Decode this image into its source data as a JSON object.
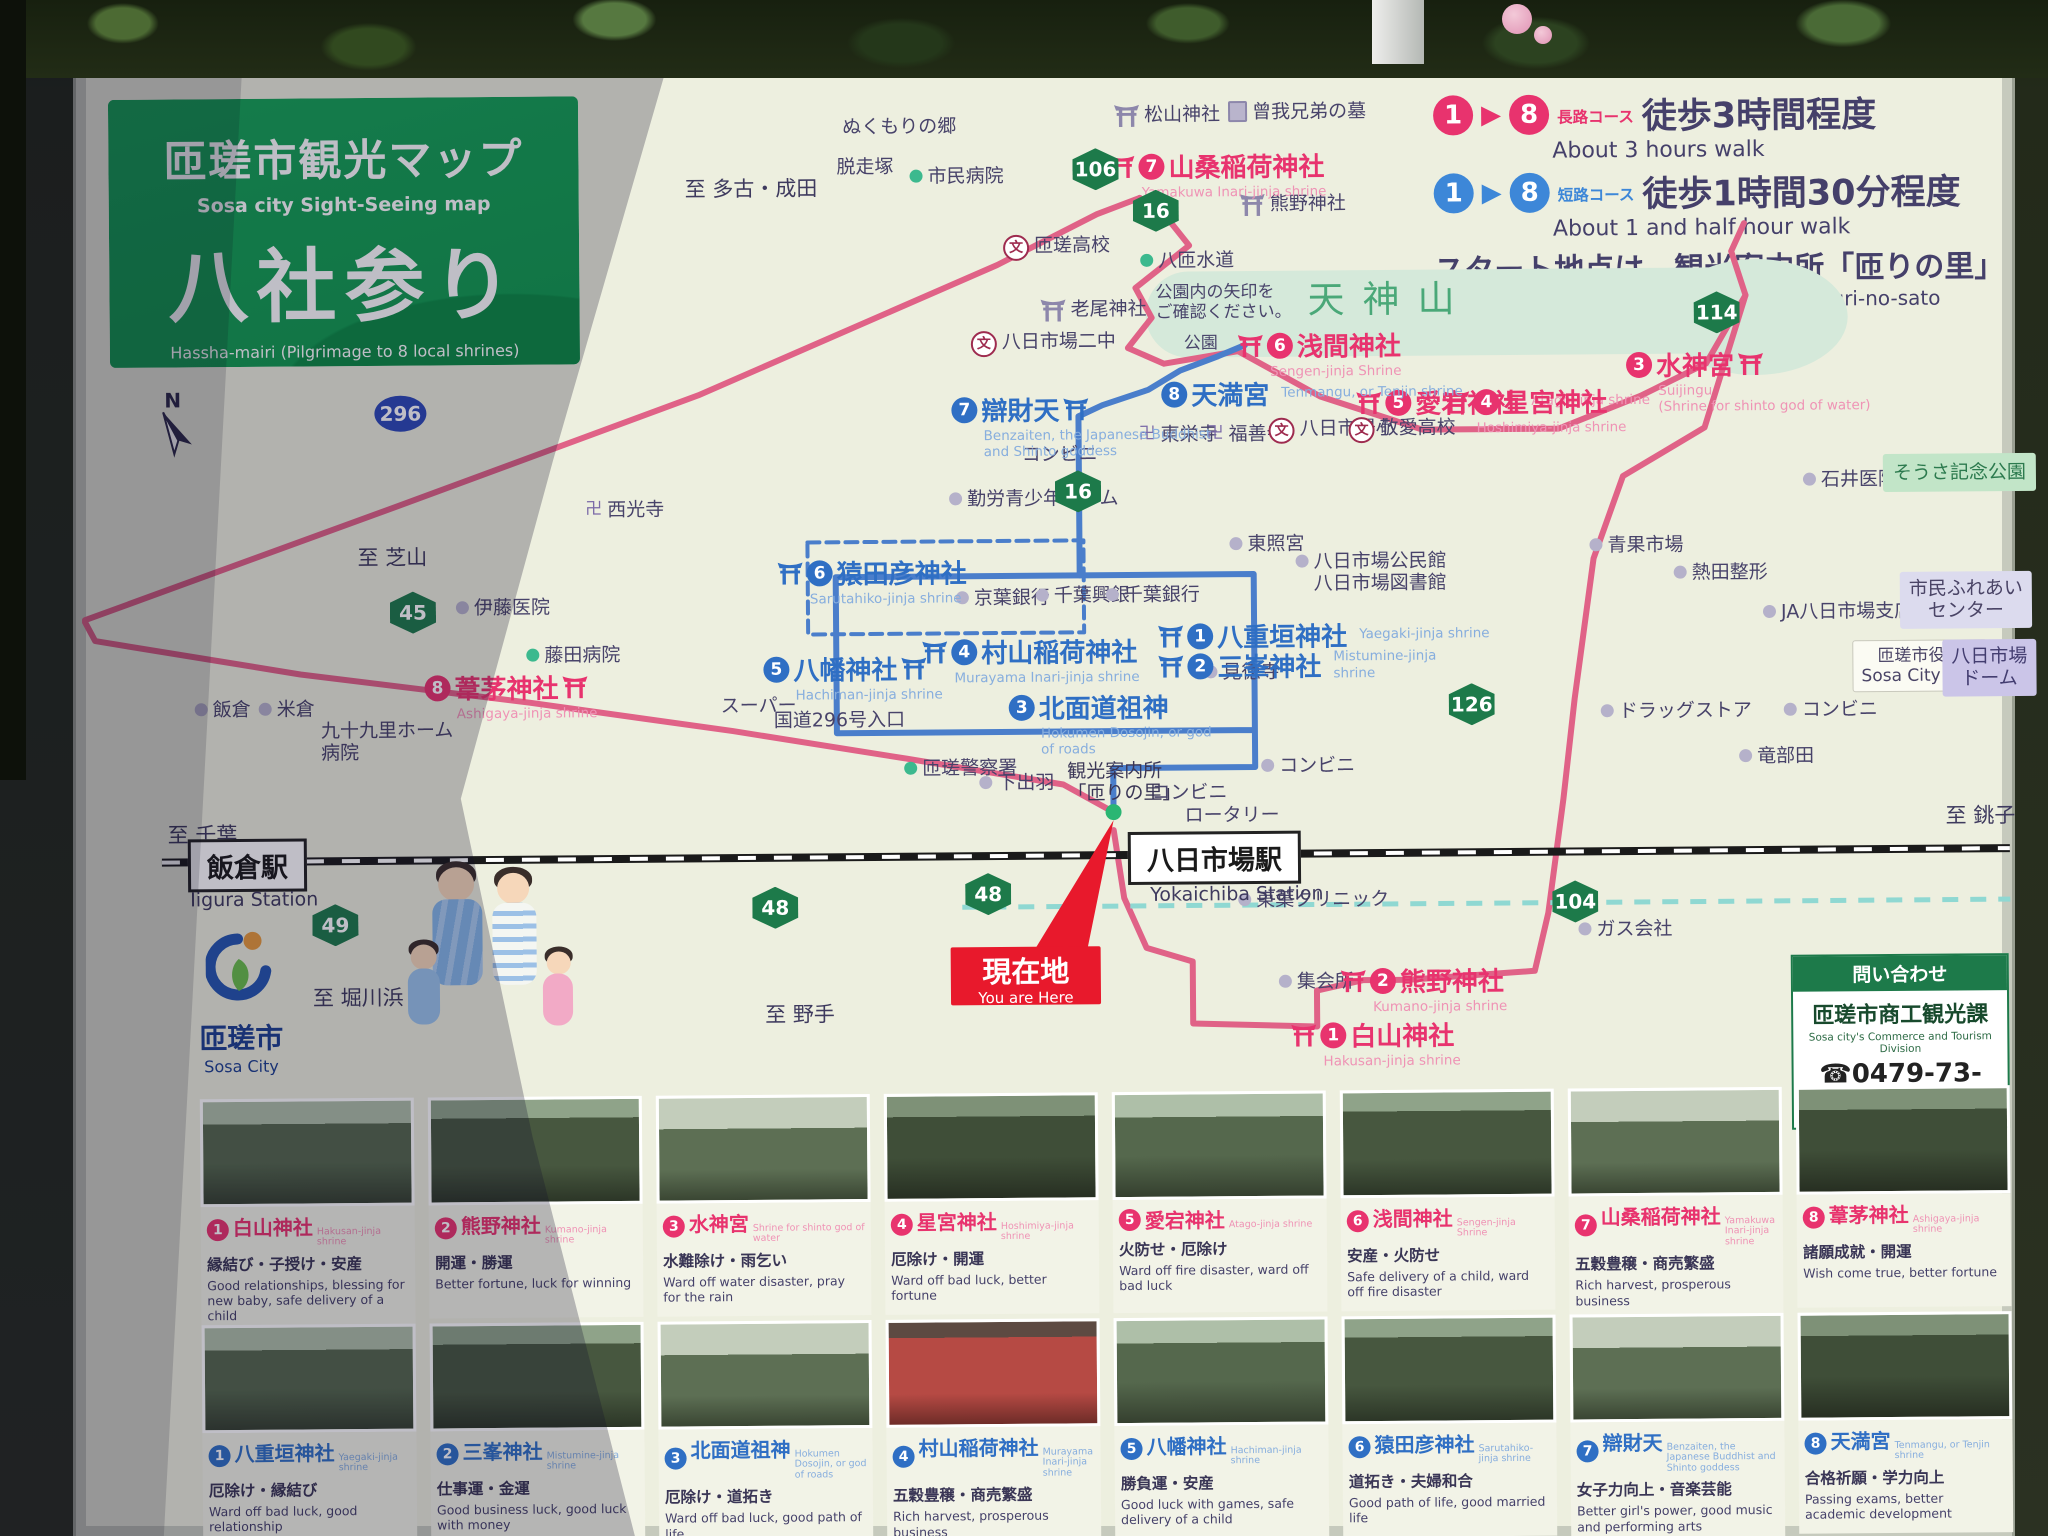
{
  "sign": {
    "title_jp": "匝瑳市観光マップ",
    "title_en": "Sosa city Sight-Seeing map",
    "subtitle_jp": "八社参り",
    "subtitle_en": "Hassha-mairi (Pilgrimage to 8 local shrines)"
  },
  "legend": {
    "long": {
      "from": "1",
      "to": "8",
      "arrow": "▶",
      "course_jp": "長路コース",
      "detail_jp": "徒歩3時間程度",
      "en": "About 3 hours walk",
      "color": "#e8336e"
    },
    "short": {
      "from": "1",
      "to": "8",
      "arrow": "▶",
      "course_jp": "短路コース",
      "detail_jp": "徒歩1時間30分程度",
      "en": "About 1 and half hour walk",
      "color": "#3d87d8"
    },
    "start_jp": "スタート地点は、観光案内所「匝りの里」",
    "start_en": "Start at tourist information center, Meguri-no-sato"
  },
  "compass_label": "N",
  "you_are_here": {
    "jp": "現在地",
    "en": "You are Here"
  },
  "city_logo": {
    "jp": "匝瑳市",
    "en": "Sosa City"
  },
  "contact": {
    "header": "問い合わせ",
    "dept": "匝瑳市商工観光課",
    "dept_en": "Sosa city's Commerce and Tourism Division",
    "phone": "☎0479-73-0014"
  },
  "map": {
    "park_area_label": "天神山",
    "stations": [
      {
        "jp": "飯倉駅",
        "en": "Iigura Station",
        "x": 186,
        "y": 832,
        "enx": 188,
        "eny": 882
      },
      {
        "jp": "八日市場駅",
        "en": "Yokaichiba Station",
        "x": 1126,
        "y": 832,
        "enx": 1148,
        "eny": 884
      }
    ],
    "shrine_markers": [
      {
        "num": "7",
        "color": "pink",
        "name": "山桑稲荷神社",
        "romaji": "Yamakuwa Inari-jinja shrine",
        "x": 1113,
        "y": 148,
        "icon": "left",
        "rpos": "below"
      },
      {
        "num": "6",
        "color": "pink",
        "name": "浅間神社",
        "romaji": "Sengen-jinja Shrine",
        "x": 1240,
        "y": 328,
        "icon": "left",
        "rpos": "below"
      },
      {
        "num": "5",
        "color": "pink",
        "name": "愛宕神社",
        "romaji": "Atago-jinja shrine",
        "x": 1358,
        "y": 386,
        "icon": "left",
        "rpos": "right"
      },
      {
        "num": "4",
        "color": "pink",
        "name": "星宮神社",
        "romaji": "Hoshimiya-jinja shrine",
        "x": 1446,
        "y": 386,
        "icon": "left",
        "rpos": "below"
      },
      {
        "num": "3",
        "color": "pink",
        "name": "水神宮",
        "romaji": "Suijingu\n(Shrine for shinto god of water)",
        "x": 1628,
        "y": 350,
        "icon": "right",
        "rpos": "below"
      },
      {
        "num": "8",
        "color": "pink",
        "name": "葦茅神社",
        "romaji": "Ashigaya-jinja shrine",
        "x": 424,
        "y": 664,
        "icon": "right",
        "rpos": "below"
      },
      {
        "num": "2",
        "color": "pink",
        "name": "熊野神社",
        "romaji": "Kumano-jinja shrine",
        "x": 1338,
        "y": 964,
        "icon": "left",
        "rpos": "below"
      },
      {
        "num": "1",
        "color": "pink",
        "name": "白山神社",
        "romaji": "Hakusan-jinja shrine",
        "x": 1288,
        "y": 1018,
        "icon": "left",
        "rpos": "below"
      },
      {
        "num": "7",
        "color": "blue",
        "name": "辯財天",
        "romaji": "Benzaiten, the Japanese Buddhist\nand Shinto goddess",
        "x": 953,
        "y": 390,
        "icon": "right",
        "rpos": "below"
      },
      {
        "num": "8",
        "color": "blue",
        "name": "天満宮",
        "romaji": "Tenmangu, or Tenjin shrine",
        "x": 1163,
        "y": 376,
        "icon": "none",
        "rpos": "right"
      },
      {
        "num": "6",
        "color": "blue",
        "name": "猿田彦神社",
        "romaji": "Sarutahiko-jinja shrine",
        "x": 778,
        "y": 552,
        "icon": "left",
        "rpos": "below"
      },
      {
        "num": "5",
        "color": "blue",
        "name": "八幡神社",
        "romaji": "Hachiman-jinja shrine",
        "x": 763,
        "y": 648,
        "icon": "right",
        "rpos": "below"
      },
      {
        "num": "4",
        "color": "blue",
        "name": "村山稲荷神社",
        "romaji": "Murayama Inari-jinja shrine",
        "x": 922,
        "y": 632,
        "icon": "left",
        "rpos": "below"
      },
      {
        "num": "3",
        "color": "blue",
        "name": "北面道祖神",
        "romaji": "Hokumen Dosojin, or god\nof roads",
        "x": 1008,
        "y": 688,
        "icon": "none",
        "rpos": "below"
      },
      {
        "num": "1",
        "color": "blue",
        "name": "八重垣神社",
        "romaji": "Yaegaki-jinja shrine",
        "x": 1158,
        "y": 618,
        "icon": "left",
        "rpos": "right"
      },
      {
        "num": "2",
        "color": "blue",
        "name": "三峯神社",
        "romaji": "Mistumine-jinja\nshrine",
        "x": 1158,
        "y": 648,
        "icon": "left",
        "rpos": "right"
      }
    ],
    "labels": [
      {
        "t": "松山神社",
        "x": 1118,
        "y": 104,
        "icon": "torii"
      },
      {
        "t": "曾我兄弟の墓",
        "x": 1232,
        "y": 102,
        "icon": "grave"
      },
      {
        "t": "ぬくもりの郷",
        "x": 846,
        "y": 114
      },
      {
        "t": "脱走塚",
        "x": 840,
        "y": 154
      },
      {
        "t": "市民病院",
        "x": 913,
        "y": 164,
        "icon": "dotg"
      },
      {
        "t": "至 多古・成田",
        "x": 688,
        "y": 174,
        "cls": "dir"
      },
      {
        "t": "熊野神社",
        "x": 1243,
        "y": 194,
        "icon": "torii"
      },
      {
        "t": "八匝水道",
        "x": 1143,
        "y": 250,
        "icon": "dotg"
      },
      {
        "t": "匝瑳高校",
        "x": 1006,
        "y": 234,
        "icon": "school"
      },
      {
        "t": "老尾神社",
        "x": 1043,
        "y": 298,
        "icon": "torii"
      },
      {
        "t": "八日市場二中",
        "x": 973,
        "y": 330,
        "icon": "school"
      },
      {
        "t": "公園内の矢印を\nご確認ください。",
        "x": 1158,
        "y": 283,
        "cls": "note"
      },
      {
        "t": "公園",
        "x": 1186,
        "y": 334,
        "cls": "note"
      },
      {
        "t": "東栄寺",
        "x": 1140,
        "y": 424,
        "icon": "temple"
      },
      {
        "t": "福善寺",
        "x": 1208,
        "y": 424,
        "icon": "temple"
      },
      {
        "t": "八日市場小",
        "x": 1270,
        "y": 419,
        "icon": "school"
      },
      {
        "t": "敬愛高校",
        "x": 1350,
        "y": 419,
        "icon": "school"
      },
      {
        "t": "コンビニ",
        "x": 1023,
        "y": 443
      },
      {
        "t": "勤労青少年ホーム",
        "x": 950,
        "y": 487,
        "icon": "dot"
      },
      {
        "t": "西光寺",
        "x": 586,
        "y": 495,
        "icon": "temple"
      },
      {
        "t": "至 芝山",
        "x": 358,
        "y": 540,
        "cls": "dir"
      },
      {
        "t": "伊藤医院",
        "x": 456,
        "y": 592,
        "icon": "dot"
      },
      {
        "t": "藤田病院",
        "x": 526,
        "y": 640,
        "icon": "dotg"
      },
      {
        "t": "東照宮",
        "x": 1230,
        "y": 534,
        "icon": "dot"
      },
      {
        "t": "八日市場公民館\n八日市場図書館",
        "x": 1296,
        "y": 552,
        "icon": "dot"
      },
      {
        "t": "青果市場",
        "x": 1590,
        "y": 538,
        "icon": "dot"
      },
      {
        "t": "熱田整形",
        "x": 1674,
        "y": 566,
        "icon": "dot"
      },
      {
        "t": "JA八日市場支店",
        "x": 1763,
        "y": 606,
        "icon": "dot"
      },
      {
        "t": "市民ふれあい\nセンター",
        "x": 1900,
        "y": 578,
        "cls": "boxl"
      },
      {
        "t": "匝瑳市役所\nSosa City Hall",
        "x": 1852,
        "y": 646,
        "cls": "boxw"
      },
      {
        "t": "八日市場\nドーム",
        "x": 1942,
        "y": 646,
        "cls": "boxp"
      },
      {
        "t": "見徳寺",
        "x": 1204,
        "y": 662,
        "icon": "dot"
      },
      {
        "t": "京葉銀行",
        "x": 956,
        "y": 586,
        "icon": "dot"
      },
      {
        "t": "千葉興銀",
        "x": 1036,
        "y": 584,
        "icon": "dot"
      },
      {
        "t": "千葉銀行",
        "x": 1106,
        "y": 584,
        "icon": "dot"
      },
      {
        "t": "スーパー",
        "x": 720,
        "y": 692
      },
      {
        "t": "国道296号入口",
        "x": 773,
        "y": 707
      },
      {
        "t": "飯倉",
        "x": 194,
        "y": 692,
        "icon": "dot"
      },
      {
        "t": "米倉",
        "x": 258,
        "y": 692,
        "icon": "dot"
      },
      {
        "t": "九十九里ホーム\n病院",
        "x": 320,
        "y": 714
      },
      {
        "t": "匝瑳警察署",
        "x": 903,
        "y": 756,
        "icon": "dotg"
      },
      {
        "t": "下出羽",
        "x": 978,
        "y": 771,
        "icon": "dot"
      },
      {
        "t": "観光案内所\n「匝りの里」",
        "x": 1066,
        "y": 760,
        "cls": "dark"
      },
      {
        "t": "コンビニ",
        "x": 1150,
        "y": 782
      },
      {
        "t": "ロータリー",
        "x": 1183,
        "y": 805
      },
      {
        "t": "コンビニ",
        "x": 1260,
        "y": 756,
        "icon": "dot"
      },
      {
        "t": "ドラッグストア",
        "x": 1600,
        "y": 704,
        "icon": "dot"
      },
      {
        "t": "コンビニ",
        "x": 1783,
        "y": 704,
        "icon": "dot"
      },
      {
        "t": "竜部田",
        "x": 1738,
        "y": 750,
        "icon": "dot"
      },
      {
        "t": "石井医院",
        "x": 1804,
        "y": 474,
        "icon": "dot"
      },
      {
        "t": "そうさ記念公園",
        "x": 1884,
        "y": 460,
        "cls": "boxg"
      },
      {
        "t": "東葉クリニック",
        "x": 1236,
        "y": 890,
        "icon": "dot"
      },
      {
        "t": "ガス会社",
        "x": 1576,
        "y": 922,
        "icon": "dot"
      },
      {
        "t": "集会所",
        "x": 1276,
        "y": 972,
        "icon": "dot"
      },
      {
        "t": "至 堀川浜",
        "x": 310,
        "y": 980,
        "cls": "dir"
      },
      {
        "t": "至 野手",
        "x": 762,
        "y": 1000,
        "cls": "dir"
      },
      {
        "t": "至 千葉",
        "x": 166,
        "y": 816,
        "cls": "dir"
      },
      {
        "t": "至 銚子",
        "x": 1944,
        "y": 810,
        "cls": "dir"
      }
    ],
    "badges": [
      {
        "n": "106",
        "x": 1076,
        "y": 148
      },
      {
        "n": "16",
        "x": 1136,
        "y": 190
      },
      {
        "n": "16",
        "x": 1056,
        "y": 470
      },
      {
        "n": "296",
        "x": 376,
        "y": 390,
        "shape": "oval"
      },
      {
        "n": "45",
        "x": 390,
        "y": 586
      },
      {
        "n": "126",
        "x": 1448,
        "y": 686
      },
      {
        "n": "48",
        "x": 750,
        "y": 884
      },
      {
        "n": "48",
        "x": 963,
        "y": 872
      },
      {
        "n": "49",
        "x": 310,
        "y": 898
      },
      {
        "n": "104",
        "x": 1550,
        "y": 884
      },
      {
        "n": "114",
        "x": 1696,
        "y": 296
      }
    ]
  },
  "shrine_cards": {
    "row1": [
      {
        "num": "1",
        "name": "白山神社",
        "romaji": "Hakusan-jinja shrine",
        "jp": "縁結び・子授け・安産",
        "en": "Good relationships, blessing for new baby, safe delivery of a child"
      },
      {
        "num": "2",
        "name": "熊野神社",
        "romaji": "Kumano-jinja shrine",
        "jp": "開運・勝運",
        "en": "Better fortune, luck for winning"
      },
      {
        "num": "3",
        "name": "水神宮",
        "romaji": "Shrine for shinto god of water",
        "jp": "水難除け・雨乞い",
        "en": "Ward off water disaster, pray for the rain"
      },
      {
        "num": "4",
        "name": "星宮神社",
        "romaji": "Hoshimiya-jinja shrine",
        "jp": "厄除け・開運",
        "en": "Ward off bad luck, better fortune"
      },
      {
        "num": "5",
        "name": "愛宕神社",
        "romaji": "Atago-jinja shrine",
        "jp": "火防せ・厄除け",
        "en": "Ward off fire disaster, ward off bad luck"
      },
      {
        "num": "6",
        "name": "浅間神社",
        "romaji": "Sengen-jinja Shrine",
        "jp": "安産・火防せ",
        "en": "Safe delivery of a child, ward off fire disaster"
      },
      {
        "num": "7",
        "name": "山桑稲荷神社",
        "romaji": "Yamakuwa Inari-jinja shrine",
        "jp": "五穀豊穣・商売繁盛",
        "en": "Rich harvest, prosperous business"
      },
      {
        "num": "8",
        "name": "葦茅神社",
        "romaji": "Ashigaya-jinja shrine",
        "jp": "諸願成就・開運",
        "en": "Wish come true, better fortune"
      }
    ],
    "row2": [
      {
        "num": "1",
        "name": "八重垣神社",
        "romaji": "Yaegaki-jinja shrine",
        "jp": "厄除け・縁結び",
        "en": "Ward off bad luck, good relationship"
      },
      {
        "num": "2",
        "name": "三峯神社",
        "romaji": "Mistumine-jinja shrine",
        "jp": "仕事運・金運",
        "en": "Good business luck, good luck with money"
      },
      {
        "num": "3",
        "name": "北面道祖神",
        "romaji": "Hokumen Dosojin, or god of roads",
        "jp": "厄除け・道拓き",
        "en": "Ward off bad luck, good path of life"
      },
      {
        "num": "4",
        "name": "村山稲荷神社",
        "romaji": "Murayama Inari-jinja shrine",
        "jp": "五穀豊穣・商売繁盛",
        "en": "Rich harvest, prosperous business"
      },
      {
        "num": "5",
        "name": "八幡神社",
        "romaji": "Hachiman-jinja shrine",
        "jp": "勝負運・安産",
        "en": "Good luck with games, safe delivery of a child"
      },
      {
        "num": "6",
        "name": "猿田彦神社",
        "romaji": "Sarutahiko-jinja shrine",
        "jp": "道拓き・夫婦和合",
        "en": "Good path of life, good married life"
      },
      {
        "num": "7",
        "name": "辯財天",
        "romaji": "Benzaiten, the Japanese Buddhist and Shinto goddess",
        "jp": "女子力向上・音楽芸能",
        "en": "Better girl's power, good music and performing arts"
      },
      {
        "num": "8",
        "name": "天満宮",
        "romaji": "Tenmangu, or Tenjin shrine",
        "jp": "合格祈願・学力向上",
        "en": "Passing exams, better academic development"
      }
    ]
  }
}
